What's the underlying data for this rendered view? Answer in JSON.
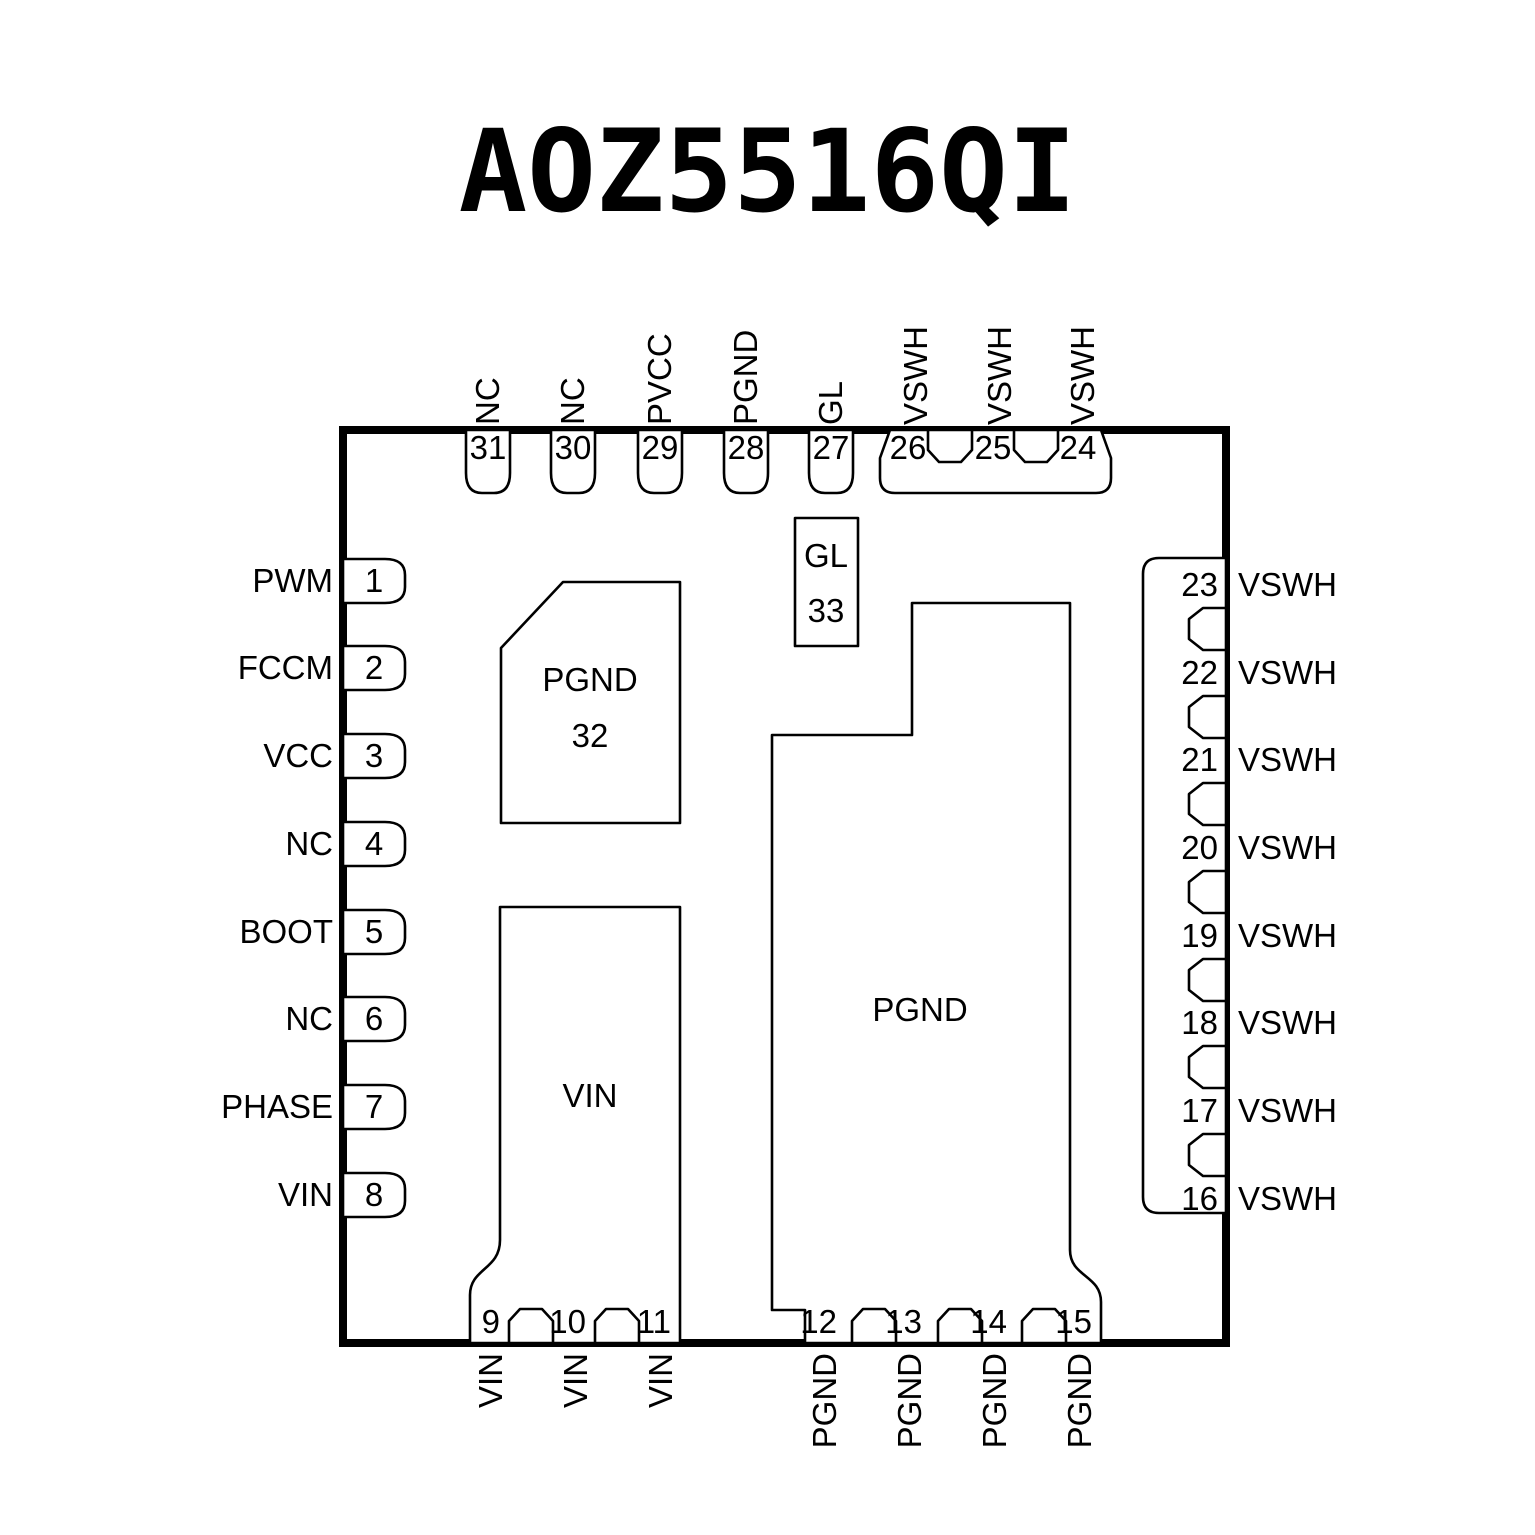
{
  "title": "AOZ5516QI",
  "package": {
    "left_pins": [
      {
        "num": "1",
        "label": "PWM"
      },
      {
        "num": "2",
        "label": "FCCM"
      },
      {
        "num": "3",
        "label": "VCC"
      },
      {
        "num": "4",
        "label": "NC"
      },
      {
        "num": "5",
        "label": "BOOT"
      },
      {
        "num": "6",
        "label": "NC"
      },
      {
        "num": "7",
        "label": "PHASE"
      },
      {
        "num": "8",
        "label": "VIN"
      }
    ],
    "top_pins": [
      {
        "num": "31",
        "label": "NC"
      },
      {
        "num": "30",
        "label": "NC"
      },
      {
        "num": "29",
        "label": "PVCC"
      },
      {
        "num": "28",
        "label": "PGND"
      },
      {
        "num": "27",
        "label": "GL"
      },
      {
        "num": "26",
        "label": "VSWH"
      },
      {
        "num": "25",
        "label": "VSWH"
      },
      {
        "num": "24",
        "label": "VSWH"
      }
    ],
    "right_pins": [
      {
        "num": "23",
        "label": "VSWH"
      },
      {
        "num": "22",
        "label": "VSWH"
      },
      {
        "num": "21",
        "label": "VSWH"
      },
      {
        "num": "20",
        "label": "VSWH"
      },
      {
        "num": "19",
        "label": "VSWH"
      },
      {
        "num": "18",
        "label": "VSWH"
      },
      {
        "num": "17",
        "label": "VSWH"
      },
      {
        "num": "16",
        "label": "VSWH"
      }
    ],
    "bottom_pins": [
      {
        "num": "9",
        "label": "VIN"
      },
      {
        "num": "10",
        "label": "VIN"
      },
      {
        "num": "11",
        "label": "VIN"
      },
      {
        "num": "12",
        "label": "PGND"
      },
      {
        "num": "13",
        "label": "PGND"
      },
      {
        "num": "14",
        "label": "PGND"
      },
      {
        "num": "15",
        "label": "PGND"
      }
    ],
    "inner_pads": {
      "pgnd_32": {
        "label": "PGND",
        "num": "32"
      },
      "gl_33": {
        "label": "GL",
        "num": "33"
      },
      "vin": {
        "label": "VIN"
      },
      "pgnd": {
        "label": "PGND"
      }
    }
  },
  "colors": {
    "outline": "#000000",
    "text": "#000000",
    "background": "#ffffff"
  }
}
